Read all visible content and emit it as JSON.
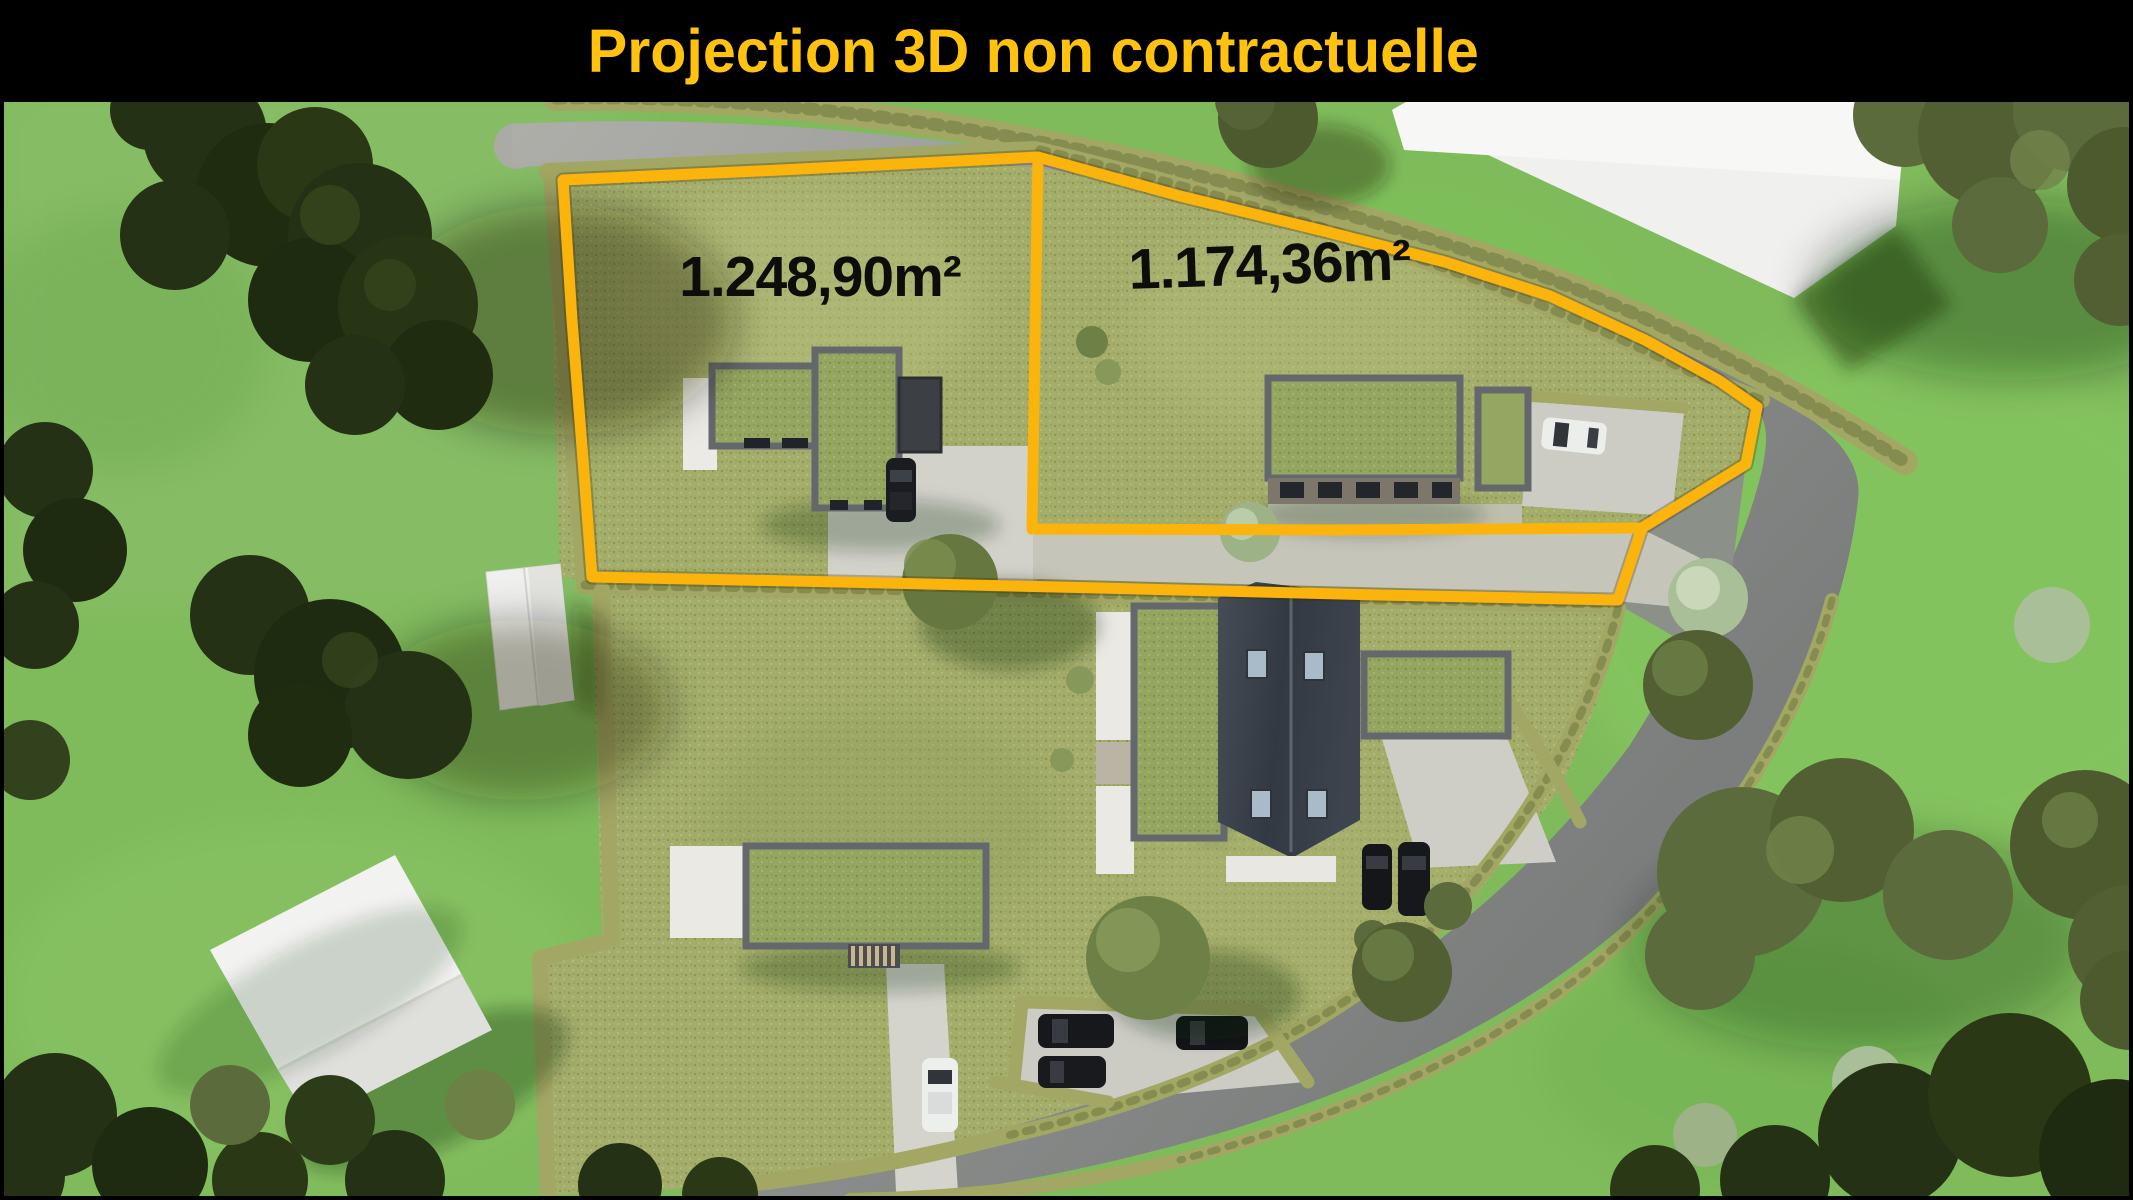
{
  "banner": {
    "title": "Projection 3D non contractuelle"
  },
  "parcels": {
    "left": {
      "area_label": "1.248,90m²"
    },
    "right": {
      "area_label": "1.174,36m²"
    }
  },
  "colors": {
    "banner_bg": "#000000",
    "title_text": "#FFC20E",
    "parcel_outline": "#FBB40B",
    "area_label_text": "#0D0E09"
  }
}
